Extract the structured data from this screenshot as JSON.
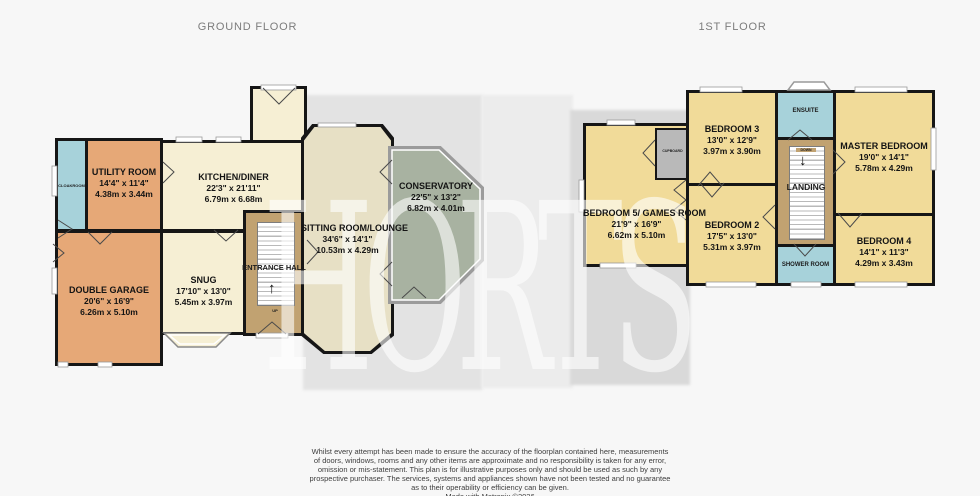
{
  "titles": {
    "ground": "GROUND FLOOR",
    "first": "1ST FLOOR"
  },
  "watermark": "HORTS",
  "icons": {
    "up_arrow": "↑",
    "down_arrow": "↓"
  },
  "colors": {
    "orange": "#e6a877",
    "cream": "#f6efd4",
    "beige": "#e7e0c5",
    "green": "#a8b2a1",
    "brown": "#c1a271",
    "blue": "#a7d2da",
    "yellow": "#f1db99",
    "cupboard-gray": "#b9b9b9",
    "wall": "#161616",
    "shadow-dark": "#d9d9d9",
    "shadow-mid": "#e3e3e3",
    "shadow-light": "#ececec"
  },
  "ground": {
    "cloakroom": {
      "name": "CLOAKROOM"
    },
    "utility": {
      "name": "UTILITY ROOM",
      "imp": "14'4\" x 11'4\"",
      "met": "4.38m x 3.44m"
    },
    "kitchen": {
      "name": "KITCHEN/DINER",
      "imp": "22'3\" x 21'11\"",
      "met": "6.79m x 6.68m"
    },
    "garage": {
      "name": "DOUBLE GARAGE",
      "imp": "20'6\" x 16'9\"",
      "met": "6.26m x 5.10m"
    },
    "snug": {
      "name": "SNUG",
      "imp": "17'10\" x 13'0\"",
      "met": "5.45m x 3.97m"
    },
    "hall": {
      "name": "ENTRANCE HALL",
      "stairs": "UP"
    },
    "sitting": {
      "name": "SITTING ROOM/LOUNGE",
      "imp": "34'6\" x 14'1\"",
      "met": "10.53m x 4.29m"
    },
    "conservatory": {
      "name": "CONSERVATORY",
      "imp": "22'5\" x 13'2\"",
      "met": "6.82m x 4.01m"
    }
  },
  "first": {
    "bedroom5": {
      "name": "BEDROOM 5/ GAMES ROOM",
      "imp": "21'9\" x 16'9\"",
      "met": "6.62m x 5.10m"
    },
    "cupboard": {
      "name": "CUPBOARD"
    },
    "bedroom3": {
      "name": "BEDROOM 3",
      "imp": "13'0\" x 12'9\"",
      "met": "3.97m x 3.90m"
    },
    "ensuite": {
      "name": "ENSUITE"
    },
    "master": {
      "name": "MASTER BEDROOM",
      "imp": "19'0\" x 14'1\"",
      "met": "5.78m x 4.29m"
    },
    "landing": {
      "name": "LANDING",
      "stairs": "DOWN"
    },
    "bedroom2": {
      "name": "BEDROOM 2",
      "imp": "17'5\" x 13'0\"",
      "met": "5.31m x 3.97m"
    },
    "shower": {
      "name": "SHOWER ROOM"
    },
    "bedroom4": {
      "name": "BEDROOM 4",
      "imp": "14'1\" x 11'3\"",
      "met": "4.29m x 3.43m"
    }
  },
  "disclaimer": {
    "lines": [
      "Whilst every attempt has been made to ensure the accuracy of the floorplan contained here, measurements",
      "of doors, windows, rooms and any other items are approximate and no responsibility is taken for any error,",
      "omission or mis-statement. This plan is for illustrative purposes only and should be used as such by any",
      "prospective purchaser. The services, systems and appliances shown have not been tested and no guarantee",
      "as to their operability or efficiency can be given.",
      "Made with Metropix ©2026"
    ]
  }
}
